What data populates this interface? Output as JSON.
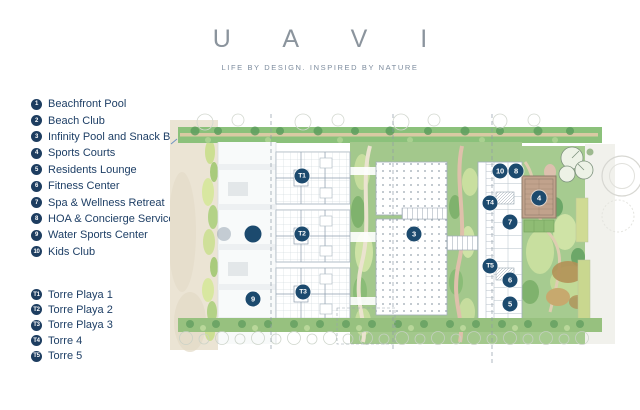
{
  "header": {
    "title": "U A V I",
    "tagline": "LIFE BY DESIGN. INSPIRED BY NATURE"
  },
  "legend": {
    "amenities": [
      {
        "num": "1",
        "label": "Beachfront Pool"
      },
      {
        "num": "2",
        "label": "Beach Club"
      },
      {
        "num": "3",
        "label": "Infinity Pool and Snack Bar"
      },
      {
        "num": "4",
        "label": "Sports Courts"
      },
      {
        "num": "5",
        "label": "Residents Lounge"
      },
      {
        "num": "6",
        "label": "Fitness Center"
      },
      {
        "num": "7",
        "label": "Spa & Wellness Retreat"
      },
      {
        "num": "8",
        "label": "HOA & Concierge Service"
      },
      {
        "num": "9",
        "label": "Water Sports Center"
      },
      {
        "num": "10",
        "label": "Kids Club"
      }
    ],
    "towers": [
      {
        "num": "T1",
        "label": "Torre Playa 1"
      },
      {
        "num": "T2",
        "label": "Torre Playa 2"
      },
      {
        "num": "T3",
        "label": "Torre Playa 3"
      },
      {
        "num": "T4",
        "label": "Torre 4"
      },
      {
        "num": "T5",
        "label": "Torre 5"
      }
    ]
  },
  "map": {
    "markers": [
      {
        "label": "T1",
        "kind": "tower",
        "x": 302,
        "y": 176
      },
      {
        "label": "T2",
        "kind": "tower",
        "x": 302,
        "y": 234
      },
      {
        "label": "T3",
        "kind": "tower",
        "x": 303,
        "y": 292
      },
      {
        "label": "T4",
        "kind": "tower",
        "x": 490,
        "y": 203
      },
      {
        "label": "T5",
        "kind": "tower",
        "x": 490,
        "y": 266
      },
      {
        "label": "3",
        "x": 414,
        "y": 234
      },
      {
        "label": "4",
        "x": 539,
        "y": 198
      },
      {
        "label": "5",
        "x": 510,
        "y": 304
      },
      {
        "label": "6",
        "x": 510,
        "y": 280
      },
      {
        "label": "7",
        "x": 510,
        "y": 222
      },
      {
        "label": "8",
        "x": 516,
        "y": 171
      },
      {
        "label": "9",
        "x": 253,
        "y": 299
      },
      {
        "label": "10",
        "x": 500,
        "y": 171
      }
    ],
    "dots": [
      {
        "kind": "solid",
        "x": 253,
        "y": 234
      },
      {
        "kind": "faded",
        "x": 224,
        "y": 234
      }
    ]
  },
  "colors": {
    "brand_navy": "#1d3d60",
    "marker_navy": "#1c4a6e",
    "title_gray": "#8b949d"
  }
}
